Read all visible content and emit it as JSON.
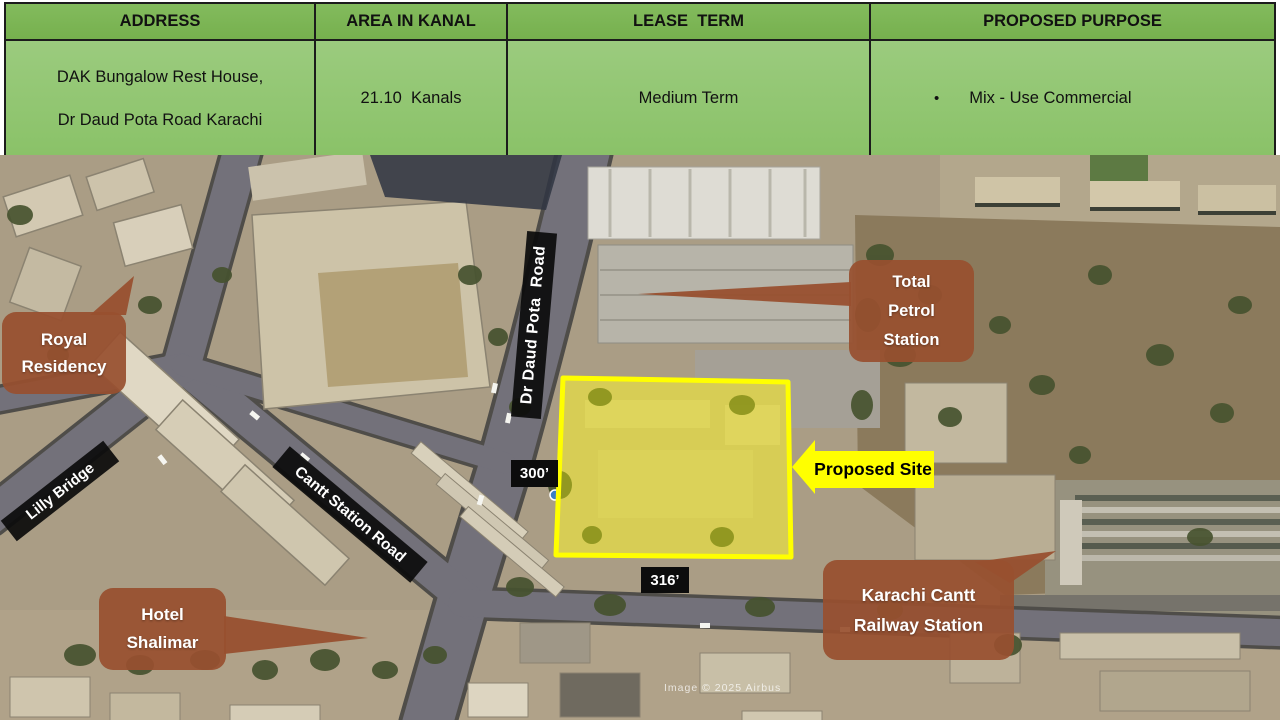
{
  "table": {
    "headers": [
      "ADDRESS",
      "AREA IN KANAL",
      "LEASE  TERM",
      "PROPOSED PURPOSE"
    ],
    "row": {
      "address_lines": [
        "DAK Bungalow Rest House,",
        "Dr Daud Pota Road Karachi"
      ],
      "area": "21.10  Kanals",
      "lease_term": "Medium Term",
      "purpose_bullet": "•",
      "purpose": "Mix - Use Commercial"
    }
  },
  "map": {
    "callouts": [
      {
        "id": "royal-residency",
        "lines": [
          "Royal",
          "Residency"
        ]
      },
      {
        "id": "total-petrol-station",
        "lines": [
          "Total",
          "Petrol",
          "Station"
        ]
      },
      {
        "id": "hotel-shalimar",
        "lines": [
          "Hotel",
          "Shalimar"
        ]
      },
      {
        "id": "karachi-cantt-railway-station",
        "lines": [
          "Karachi Cantt",
          "Railway Station"
        ]
      }
    ],
    "road_labels": [
      {
        "id": "lilly-bridge",
        "text": "Lilly Bridge"
      },
      {
        "id": "cantt-station-road",
        "text": "Cantt Station Road"
      },
      {
        "id": "dr-daud-pota-road",
        "text": "Dr Daud Pota  Road"
      }
    ],
    "measurements": [
      {
        "id": "site-width",
        "text": "300’"
      },
      {
        "id": "site-length",
        "text": "316’"
      }
    ],
    "proposed_site_label": "Proposed Site",
    "watermark": "Image © 2025 Airbus",
    "colors": {
      "table_header_green": "#7bb455",
      "table_body_green": "#92c571",
      "callout_brown": "#985030",
      "highlight_yellow": "#ffff00",
      "road_label_black": "#0c0c0c"
    }
  }
}
